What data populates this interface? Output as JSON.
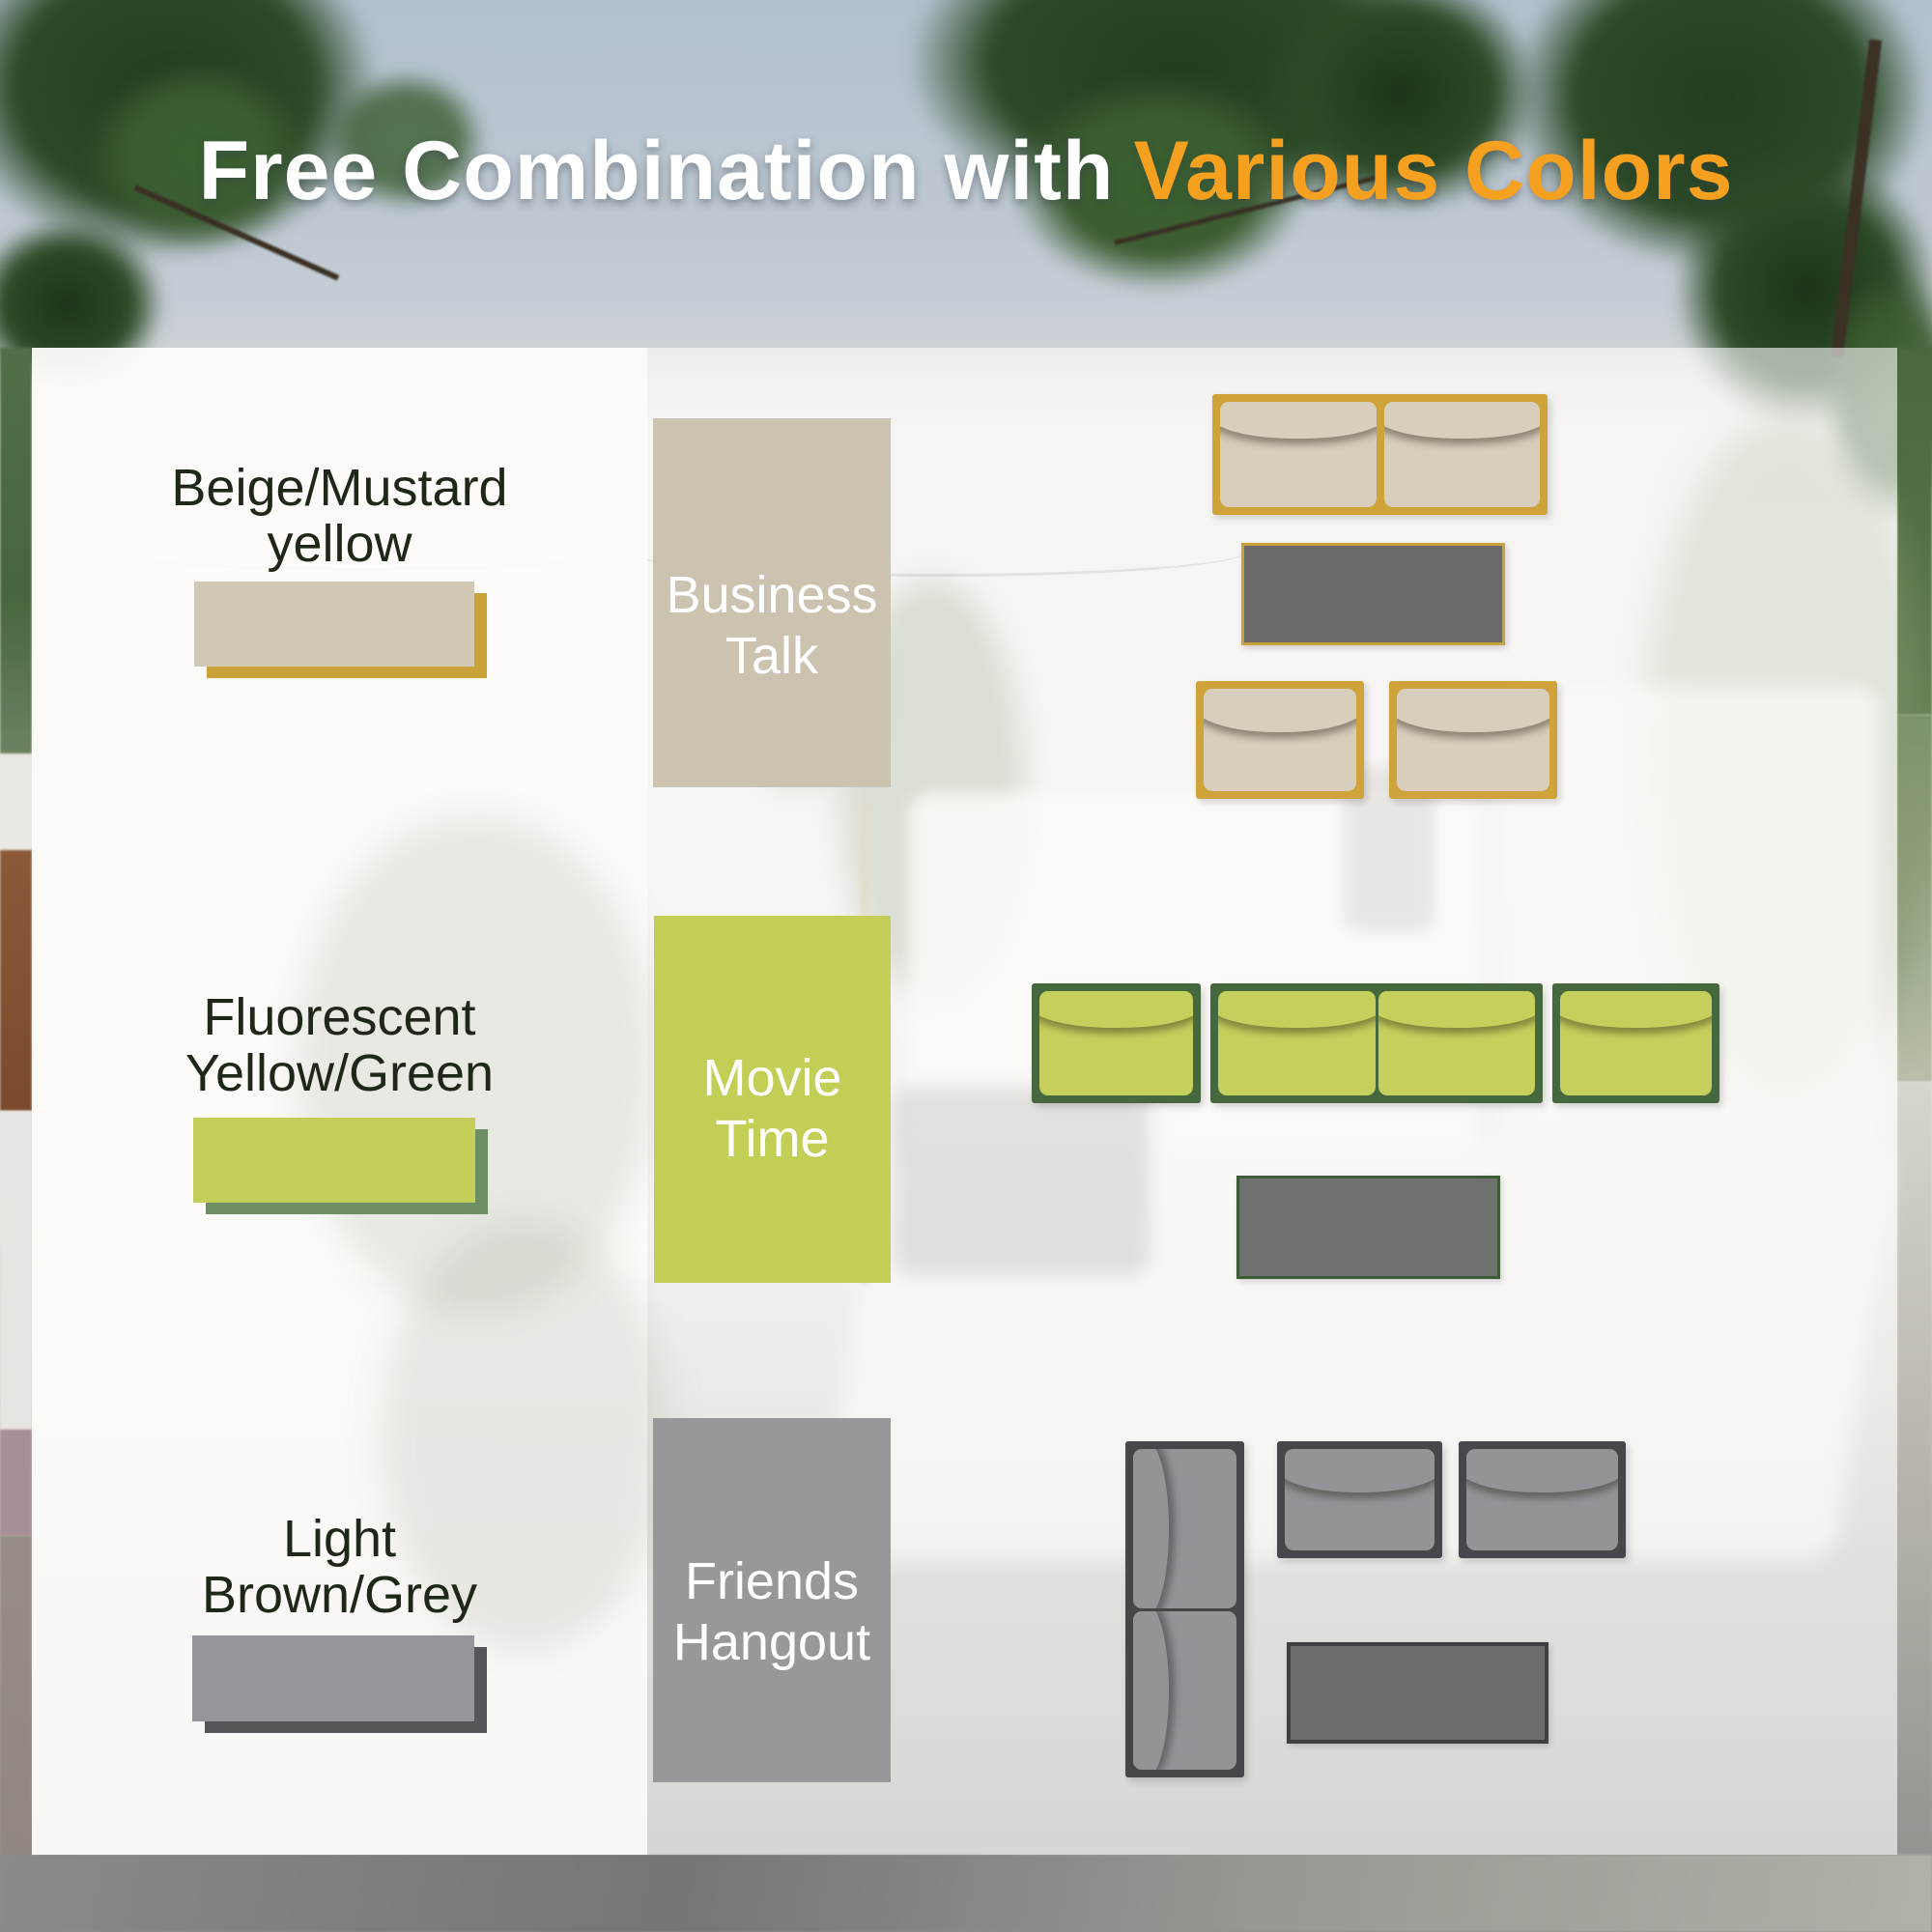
{
  "title": {
    "text_white": "Free Combination with",
    "text_accent": "Various Colors",
    "accent_color": "#f5a11f"
  },
  "options": [
    {
      "name": "Beige/Mustard yellow",
      "label_line1": "Beige/Mustard",
      "label_line2": "yellow",
      "scene": "Business Talk",
      "scene_line1": "Business",
      "scene_line2": "Talk",
      "scheme": {
        "cushion": "#d7cebb",
        "frame_accent": "#cfa23a",
        "scene_block": "#ccc2b0",
        "swatch": "#d2c8b6",
        "swatch_shadow": "#c9a23a",
        "table": "#6a6a6a"
      },
      "arrangement": [
        "2-seat sofa (two cushions)",
        "coffee table",
        "two single chairs side by side"
      ]
    },
    {
      "name": "Fluorescent Yellow/Green",
      "label_line1": "Fluorescent",
      "label_line2": "Yellow/Green",
      "scene": "Movie Time",
      "scene_line1": "Movie",
      "scene_line2": "Time",
      "scheme": {
        "cushion": "#c5d05c",
        "frame_accent": "#45683f",
        "scene_block": "#c2ce56",
        "swatch": "#c2ce58",
        "swatch_shadow": "#6d8f63",
        "table": "#70726f"
      },
      "arrangement": [
        "single chair",
        "2-seat sofa (two cushions)",
        "single chair in one row",
        "coffee table"
      ]
    },
    {
      "name": "Light Brown/Grey",
      "label_line1": "Light",
      "label_line2": "Brown/Grey",
      "scene": "Friends Hangout",
      "scene_line1": "Friends",
      "scene_line2": "Hangout",
      "scheme": {
        "cushion": "#959298",
        "frame_accent": "#47464a",
        "scene_block": "#9a979b",
        "swatch": "#97949b",
        "swatch_shadow": "#56565a",
        "table": "#6c6c6c"
      },
      "arrangement": [
        "vertical 2-seat sofa",
        "two single chairs",
        "coffee table"
      ]
    }
  ]
}
